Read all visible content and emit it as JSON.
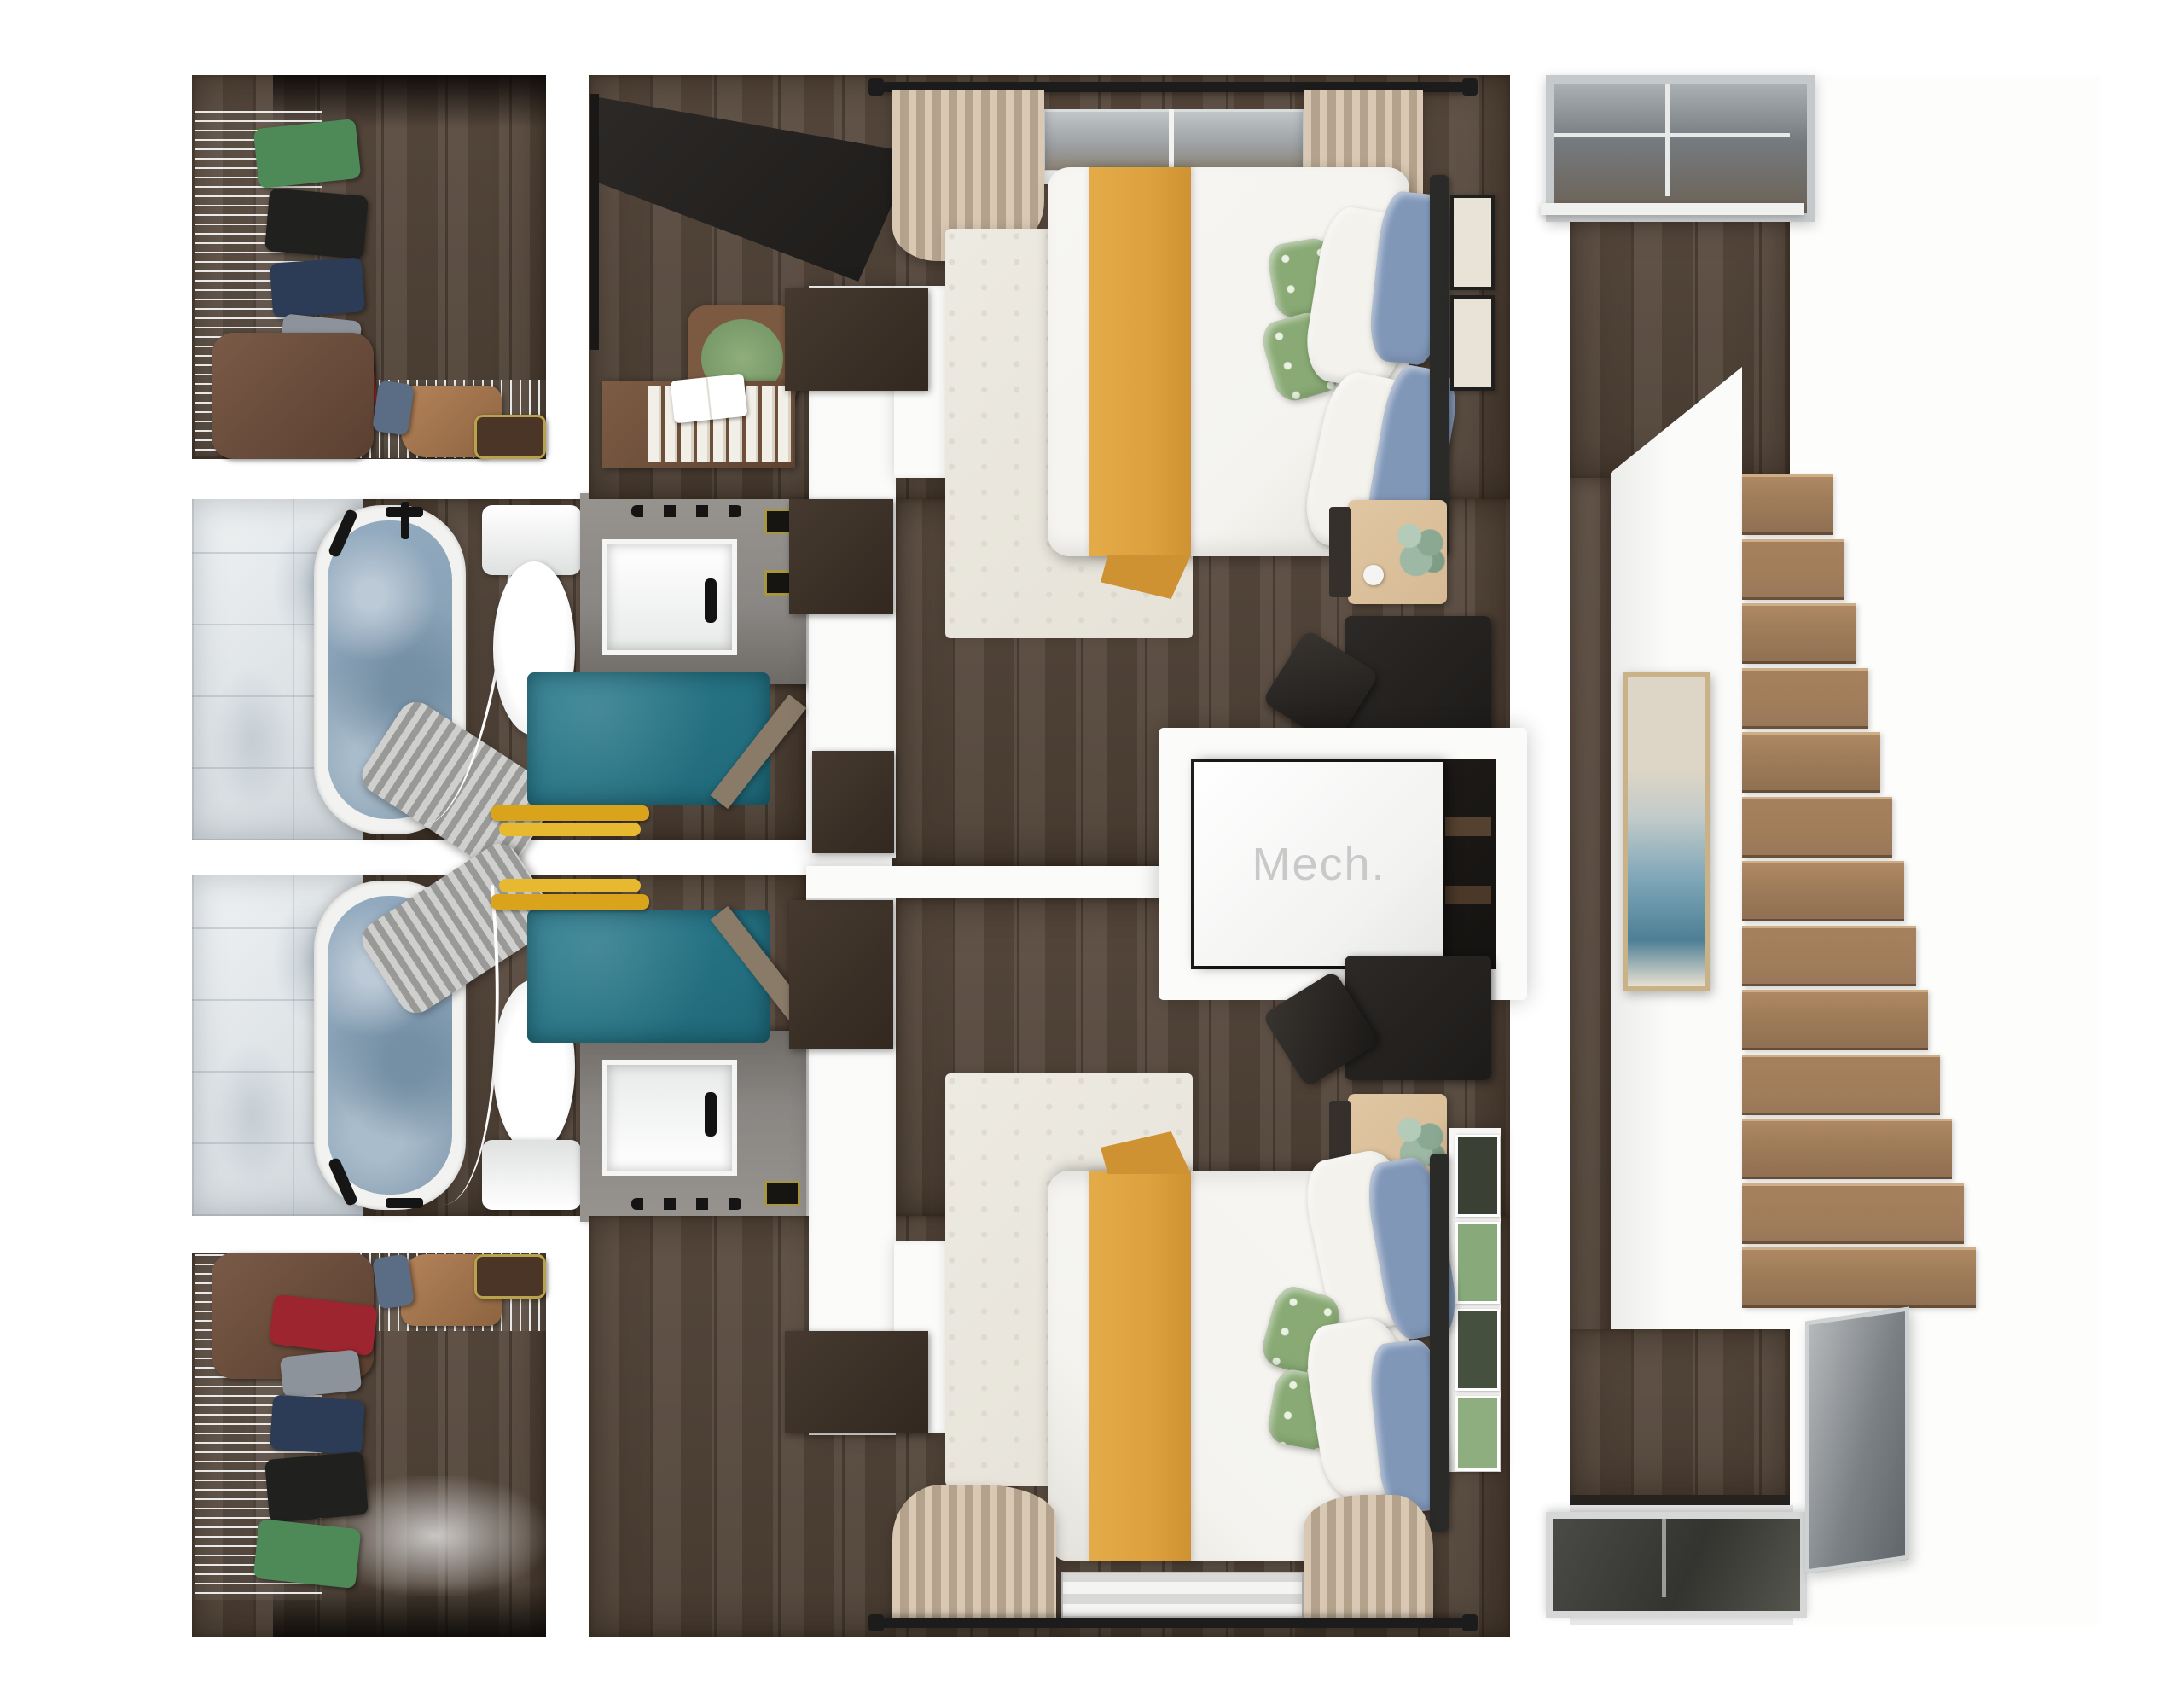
{
  "floorplan": {
    "label_mech": "Mech.",
    "rooms": [
      {
        "id": "closet-top-left",
        "name": "walk-in-closet"
      },
      {
        "id": "bathroom-top",
        "name": "bathroom"
      },
      {
        "id": "bathroom-bottom",
        "name": "bathroom"
      },
      {
        "id": "closet-bottom-left",
        "name": "walk-in-closet"
      },
      {
        "id": "bedroom-top",
        "name": "bedroom"
      },
      {
        "id": "bedroom-bottom",
        "name": "bedroom"
      },
      {
        "id": "mech-closet",
        "name": "mechanical-closet"
      },
      {
        "id": "stair-hall",
        "name": "stair-hall"
      }
    ],
    "stairs": {
      "count": 13
    },
    "icons": [
      "bed",
      "bathtub",
      "toilet",
      "sink",
      "rug",
      "closet-shelves",
      "staircase",
      "window",
      "art-frame",
      "desk",
      "nightstand",
      "plant",
      "curtains"
    ],
    "colors": {
      "wood-floor": "#4c3f34",
      "wood-floor-light": "#5a4b3f",
      "stair-wood": "#a07d5a",
      "teal-rug": "#1e6777",
      "water": "#93abc0",
      "mustard": "#dda13e",
      "mustard-shade": "#cf9232",
      "duvet": "#f4f3ef",
      "pillow-blue": "#8097b8",
      "pillow-green": "#89aa74",
      "curtain-beige": "#cdbba6",
      "rug-white": "#e6e2d8",
      "vanity-gray": "#8a8683",
      "dark-furniture": "#1d1b19",
      "door-brown": "#32281f",
      "mech-interior": "#151311",
      "mech-text": "#c9c9c9",
      "nightstand-tan": "#d6ba95",
      "plant-green": "#9db8a4",
      "towel-yellow": "#d9a41b",
      "glass-gray": "#73787c",
      "frame-silver": "#c6c9cb"
    }
  }
}
